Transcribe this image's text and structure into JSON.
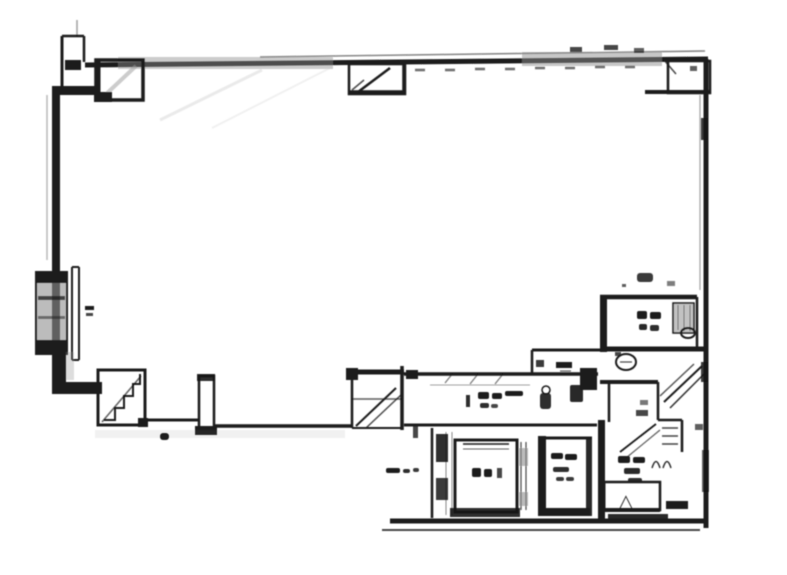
{
  "document": {
    "kind": "scanned architectural floor plan",
    "title": "",
    "background": "#ffffff"
  },
  "plan": {
    "colors": {
      "ink": "#1a1a1a",
      "scan_gray": "#8f8f8f",
      "paper": "#ffffff"
    },
    "symbols": {
      "triangle": "△"
    },
    "features": [
      {
        "name": "main-hall"
      },
      {
        "name": "elevator-shaft"
      },
      {
        "name": "staircase"
      },
      {
        "name": "toilet-room"
      },
      {
        "name": "washroom-vestibule"
      },
      {
        "name": "service-corridor"
      },
      {
        "name": "exterior-duct-shaft"
      },
      {
        "name": "structural-columns"
      }
    ],
    "notes": "room label text in the source scan is illegible (rendered as ink blobs)"
  }
}
